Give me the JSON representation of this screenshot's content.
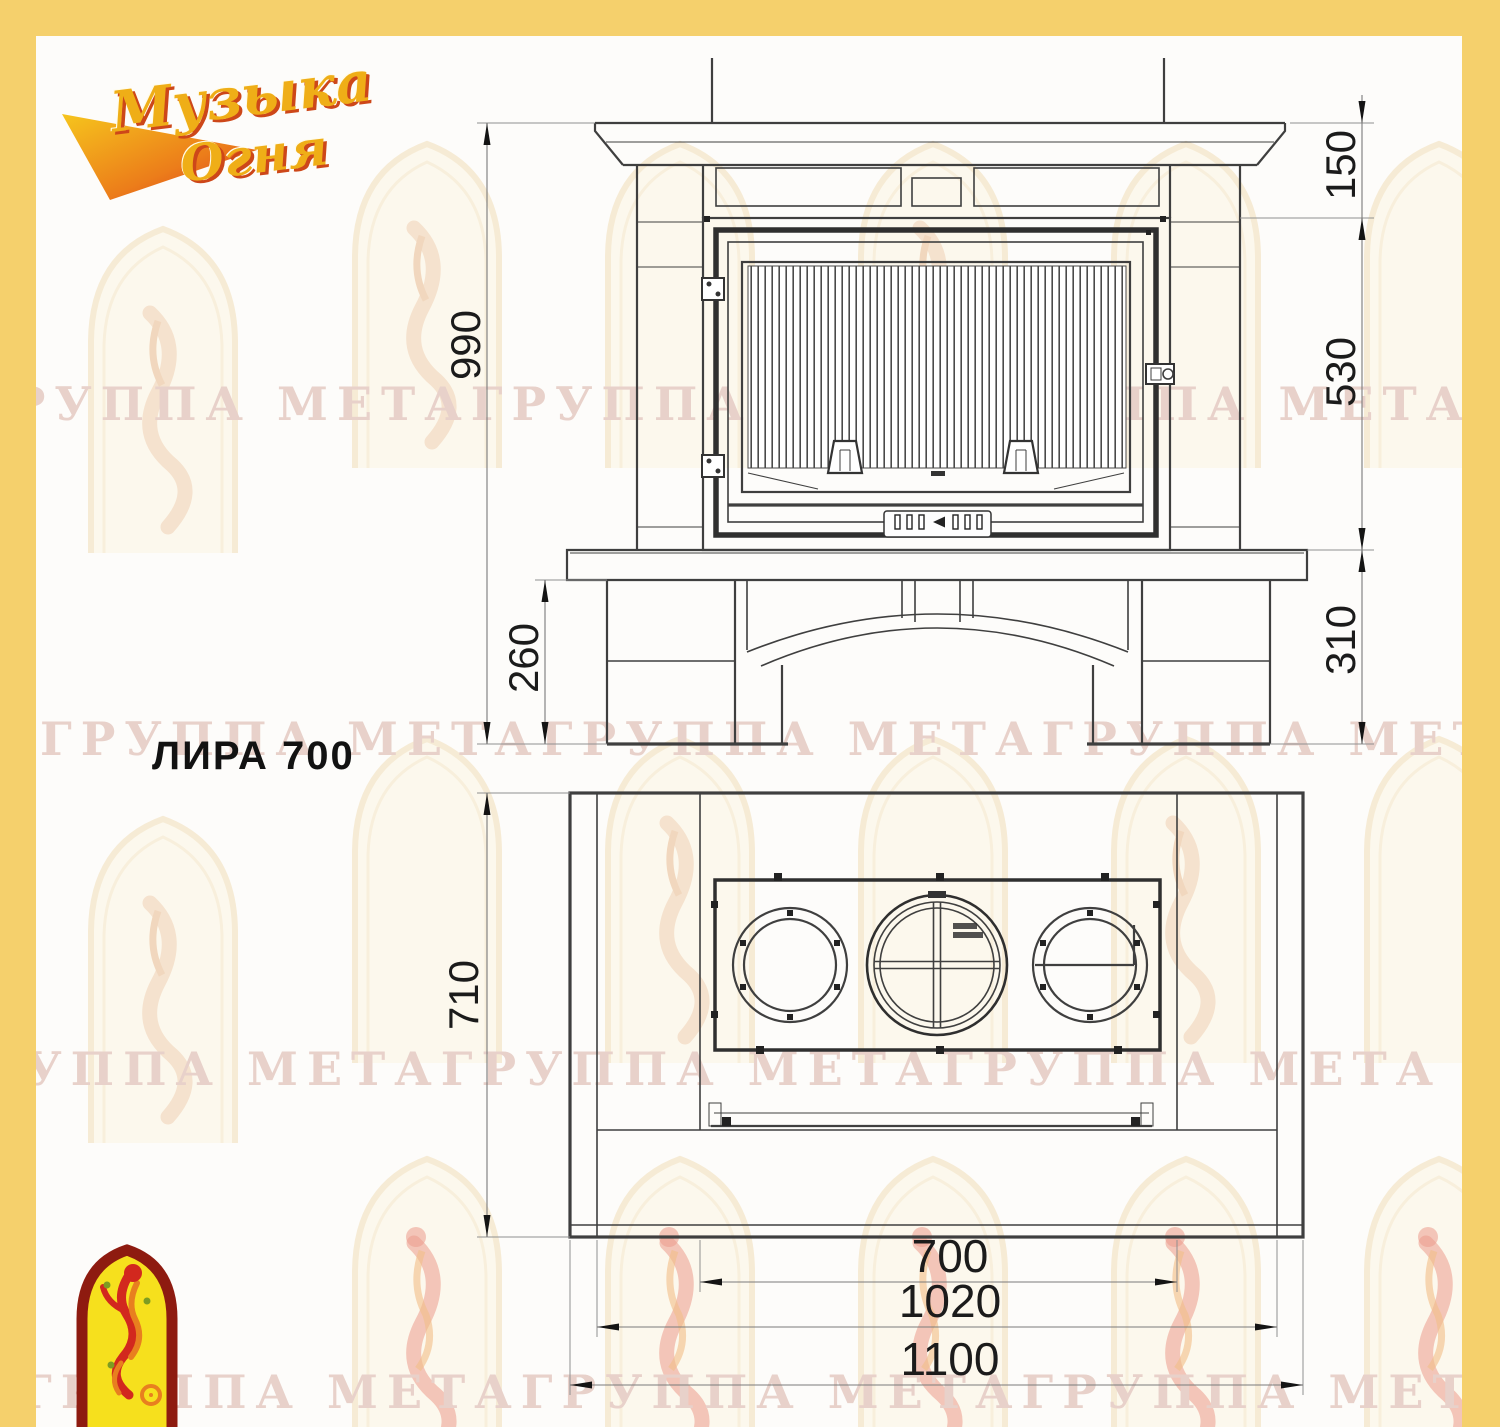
{
  "colors": {
    "border": "#f5d06c",
    "line": "#3f3f3f",
    "dimtext": "#1b1b1b",
    "wmtext": "#e8d1ca",
    "gold": "#efae17",
    "red": "#cd4719",
    "archfill": "#f6e01d",
    "archborder": "#8e1b10"
  },
  "branding": {
    "logo_line1": "Музыка",
    "logo_line2": "Огня",
    "watermark_text": "ГРУППА МЕТАГРУППА МЕТАГРУППА МЕТА"
  },
  "title": "ЛИРА 700",
  "front_view": {
    "dims": {
      "total_height": "990",
      "top_offset": "150",
      "firebox_height": "530",
      "hearth_height": "310",
      "base_height": "260"
    }
  },
  "plan_view": {
    "dims": {
      "depth": "710",
      "niche_width": "700",
      "body_width": "1020",
      "total_width": "1100"
    }
  }
}
